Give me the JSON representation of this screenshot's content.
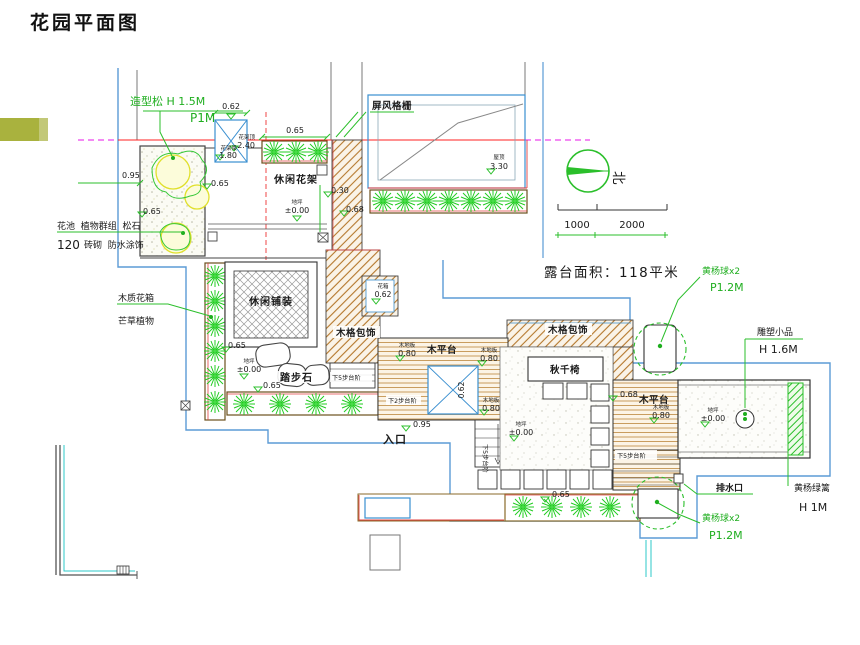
{
  "title": "花园平面图",
  "labels": {
    "shaped_pine": "造型松 H 1.5M",
    "shaped_pine_spec": "P1M",
    "screen_grille": "屏风格栅",
    "pergola": "休闲花架",
    "flowerbed_note1": "花池  植物群组  松石",
    "flowerbed_note2a": "120",
    "flowerbed_note2b": "砖砌  防水涂饰",
    "wood_planter_box": "木质花箱",
    "miscanthus": "芒草植物",
    "leisure_paving": "休闲铺装",
    "stepping_stones": "踏步石",
    "wood_lattice_cladding": "木格包饰",
    "wood_deck": "木平台",
    "swing_chair": "秋千椅",
    "entrance": "入口",
    "steps_down_5": "下5步台阶",
    "steps_down_2": "下2步台阶",
    "drain_outlet": "排水口",
    "boxwood_ball": "黄杨球x2",
    "boxwood_ball_spec": "P1.2M",
    "boxwood_hedge": "黄杨绿篱",
    "boxwood_hedge_spec": "H 1M",
    "sculpture": "雕塑小品",
    "sculpture_spec": "H 1.6M",
    "terrace_area": "露台面积：118平米",
    "north": "北"
  },
  "levels": {
    "roof_tag": "屋顶",
    "roof": "3.30",
    "ground_tag": "地坪",
    "ground": "±0.00",
    "deck_tag": "木地板",
    "deck": "0.80",
    "pergola_top_tag": "花架顶",
    "pergola_top": "2.40",
    "pergola_beam_tag": "花架梁",
    "pergola_beam": "1.80",
    "planter_tag": "花箱"
  },
  "dims": {
    "d030": "0.30",
    "d062": "0.62",
    "d065": "0.65",
    "d068": "0.68",
    "d095": "0.95"
  },
  "scale_bar": {
    "seg1": "1000",
    "seg2": "2000"
  },
  "colors": {
    "accent_bar": "#a9b23e",
    "boundary_blue": "#5b9bd5",
    "annotation_green": "#2bbf2b",
    "plant_green": "#22cc22",
    "axis_red": "#ff2020",
    "hatch_brown": "#b5782d"
  }
}
